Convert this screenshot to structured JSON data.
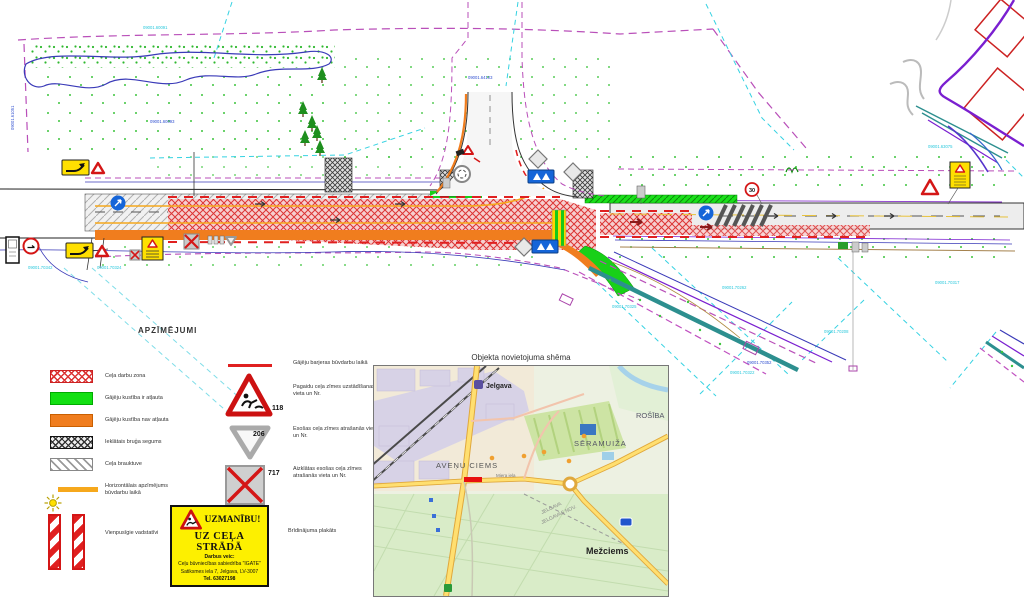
{
  "plan": {
    "parcel_labels": [
      "09001.70342",
      "09001.70324",
      "09001.60091",
      "09001.60093",
      "09001.64103",
      "09001.61051",
      "09001.70325",
      "09001.70262",
      "09001.70352",
      "09001.70322",
      "09001.70208",
      "09001.70317",
      "09001.63075"
    ],
    "sign_numbers": {
      "speed30": "30"
    }
  },
  "colors": {
    "work_zone_red": "#dc3434",
    "pedestrian_green": "#12d012",
    "no_pedestrian_orange": "#f07d1e",
    "temp_marking_yellow": "#f6a81c",
    "barrier_red": "#e02020"
  },
  "legend": {
    "title": "APZĪMĒJUMI",
    "items": [
      {
        "label": "Ceļa darbu zona"
      },
      {
        "label": "Gājēju kustība ir atļauta"
      },
      {
        "label": "Gājēju kustība nav atļauta"
      },
      {
        "label": "Ieklātais bruģa segums"
      },
      {
        "label": "Ceļa brauktuve"
      },
      {
        "label": "Horizontālais apzīmējums būvdarbu laikā"
      },
      {
        "label": "Vienpusīgie vadstatīvi"
      }
    ],
    "sign_items": [
      {
        "number": "",
        "label": "Gājēju barjeras būvdarbu laikā"
      },
      {
        "number": "118",
        "label": "Pagaidu ceļa zīmes uzstādīšanas vieta un Nr."
      },
      {
        "number": "206",
        "label": "Esošas ceļa zīmes atrašanās vieta un Nr."
      },
      {
        "number": "717",
        "label": "Aizklātas esošas ceļa zīmes atrašanās vieta un Nr."
      }
    ],
    "warning_plate": {
      "title": "UZMANĪBU!",
      "subtitle": "UZ CEĻA STRĀDĀ",
      "line1": "Darbus veic:",
      "line2": "Ceļu būvniecības sabiedrība \"IGATE\"",
      "line3": "Satiksmes iela 7, Jelgava, LV-3007",
      "line4": "Tel. 63027198",
      "caption": "Brīdinājuma plakāts"
    }
  },
  "map": {
    "title": "Objekta novietojuma shēma",
    "labels": {
      "station": "Jelgava",
      "district1": "AVEŅU CIEMS",
      "district2": "SĒRAMUIŽA",
      "district3": "ROŠĪBA",
      "street": "Miera iela",
      "district4": "Mežciems",
      "muni1": "JELGAVA",
      "muni2": "JELGAVAS NOV."
    }
  }
}
